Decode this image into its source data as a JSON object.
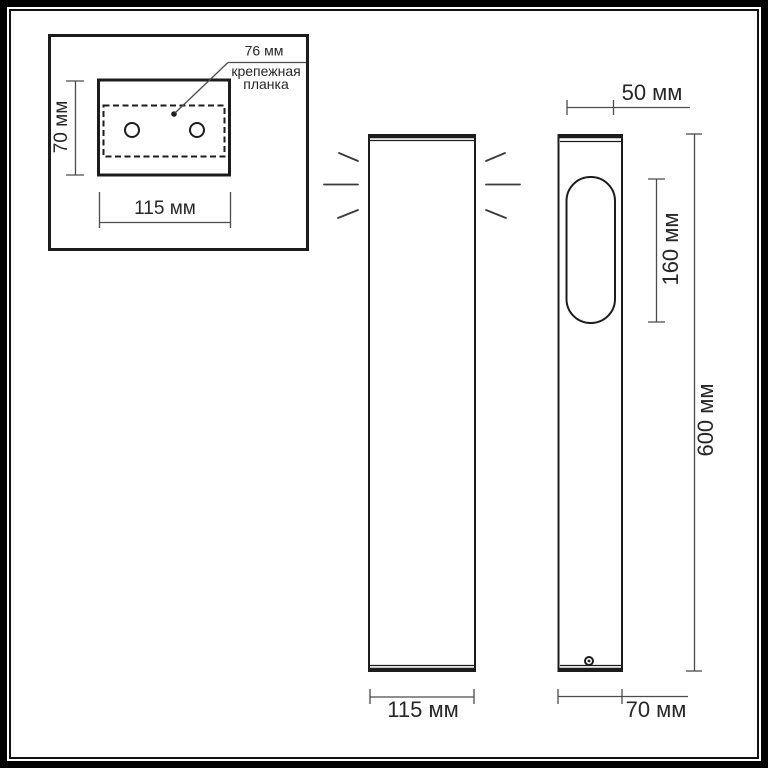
{
  "colors": {
    "background": "#ffffff",
    "line": "#1c1c1c",
    "dimension_line": "#4c4c4c",
    "text": "#262626"
  },
  "inset": {
    "callout_value": "76 мм",
    "callout_caption_line1": "крепежная",
    "callout_caption_line2": "планка",
    "height_label": "70 мм",
    "width_label": "115 мм"
  },
  "front_view": {
    "width_label": "115 мм"
  },
  "side_view": {
    "top_width_label": "50 мм",
    "window_height_label": "160 мм",
    "total_height_label": "600 мм",
    "bottom_width_label": "70 мм"
  }
}
